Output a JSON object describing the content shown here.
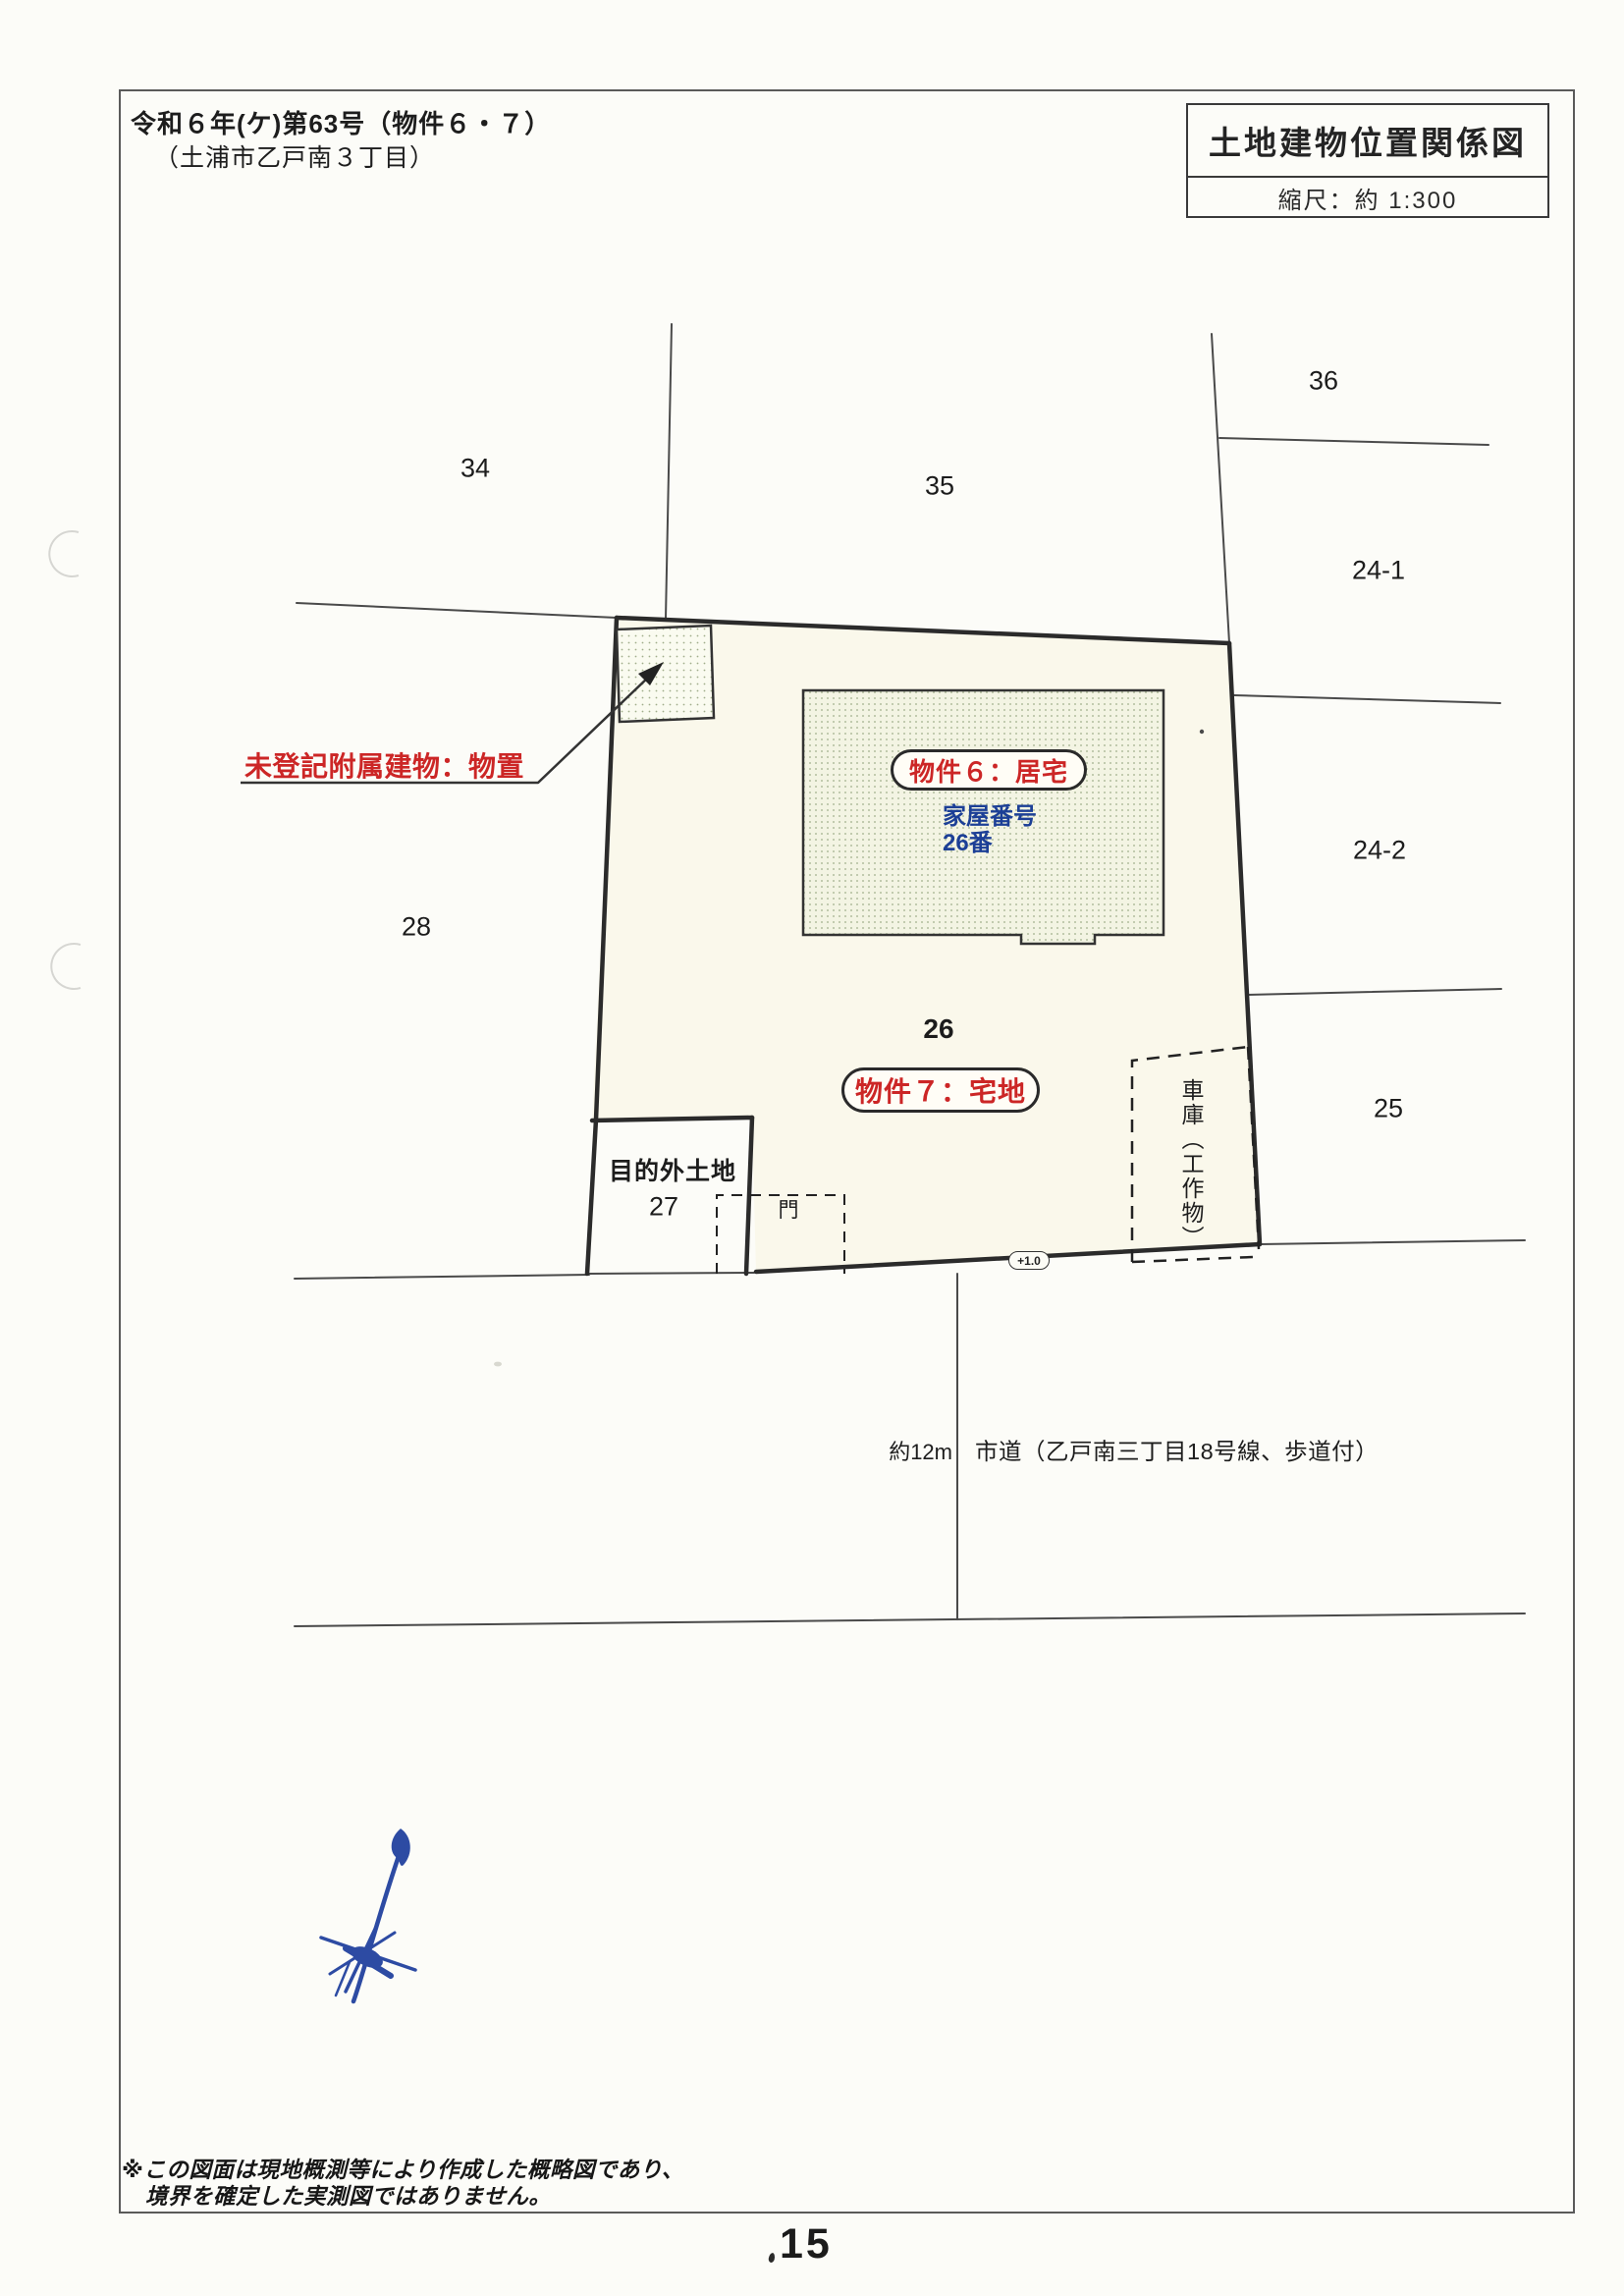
{
  "header": {
    "case_number": "令和６年(ケ)第63号（物件６・７）",
    "location": "（土浦市乙戸南３丁目）"
  },
  "title_box": {
    "title": "土地建物位置関係図",
    "scale": "縮尺：約 1:300"
  },
  "map": {
    "parcel_labels": {
      "p34": "34",
      "p35": "35",
      "p36": "36",
      "p24_1": "24-1",
      "p24_2": "24-2",
      "p25": "25",
      "p26": "26",
      "p27": "27",
      "p28": "28"
    },
    "annotations": {
      "unregistered_annex": "未登記附属建物：物置",
      "property6": "物件６：居宅",
      "house_number_line1": "家屋番号",
      "house_number_line2": "26番",
      "property7": "物件７：宅地",
      "non_purpose_land": "目的外土地",
      "gate": "門",
      "garage": "車庫（工作物）",
      "elevation_marker": "+1.0",
      "road_width": "約12m",
      "road_name": "市道（乙戸南三丁目18号線、歩道付）"
    }
  },
  "footer": {
    "note_line1": "※この図面は現地概測等により作成した概略図であり、",
    "note_line2": "境界を確定した実測図ではありません。",
    "page_number": "15"
  },
  "colors": {
    "accent_red": "#cc2626",
    "accent_blue": "#1c3f96",
    "compass_blue": "#2d4ba3",
    "boundary_thick": "#2b2b2b",
    "line_thin": "#4a4a4a",
    "parcel_fill": "#faf8eb",
    "building_fill": "#f3f4e3",
    "building_dot": "#9fae8a",
    "paper": "#fcfcf8"
  }
}
